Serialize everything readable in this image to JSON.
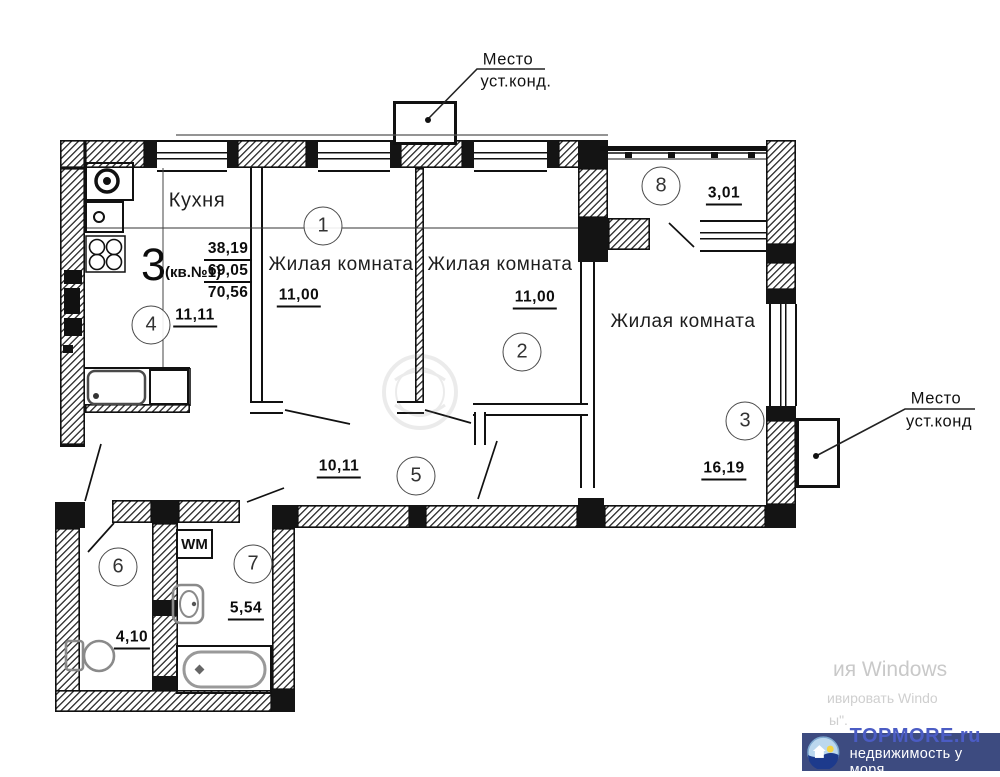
{
  "title_block": {
    "flat_type": "3",
    "flat_no": "(кв.№1)",
    "area_living": "38,19",
    "area_usable": "69,05",
    "area_total": "70,56"
  },
  "rooms": [
    {
      "num": "1",
      "label": "Жилая комната",
      "area": "11,00"
    },
    {
      "num": "2",
      "label": "Жилая комната",
      "area": "11,00"
    },
    {
      "num": "3",
      "label": "Жилая комната",
      "area": "16,19"
    },
    {
      "num": "4",
      "label": "Кухня",
      "area": "11,11"
    },
    {
      "num": "5",
      "label": "",
      "area": "10,11"
    },
    {
      "num": "6",
      "label": "",
      "area": "4,10"
    },
    {
      "num": "7",
      "label": "",
      "area": "5,54"
    },
    {
      "num": "8",
      "label": "",
      "area": "3,01"
    }
  ],
  "annotations": {
    "ac_top_l1": "Место",
    "ac_top_l2": "уст.конд.",
    "ac_right_l1": "Место",
    "ac_right_l2": "уст.конд",
    "washer": "WM"
  },
  "watermarks": {
    "win_l1": "ия Windows",
    "win_l2": "ивировать Windo",
    "win_l3": "ы\".",
    "brand_title": "TOPMORE.ru",
    "brand_sub": "недвижимость у моря"
  },
  "colors": {
    "ink": "#111111",
    "brand_bg": "#3d4b80",
    "brand_title": "#4b5cc4",
    "brand_sub": "#ffffff",
    "watermark_text": "#c9c9c9"
  }
}
